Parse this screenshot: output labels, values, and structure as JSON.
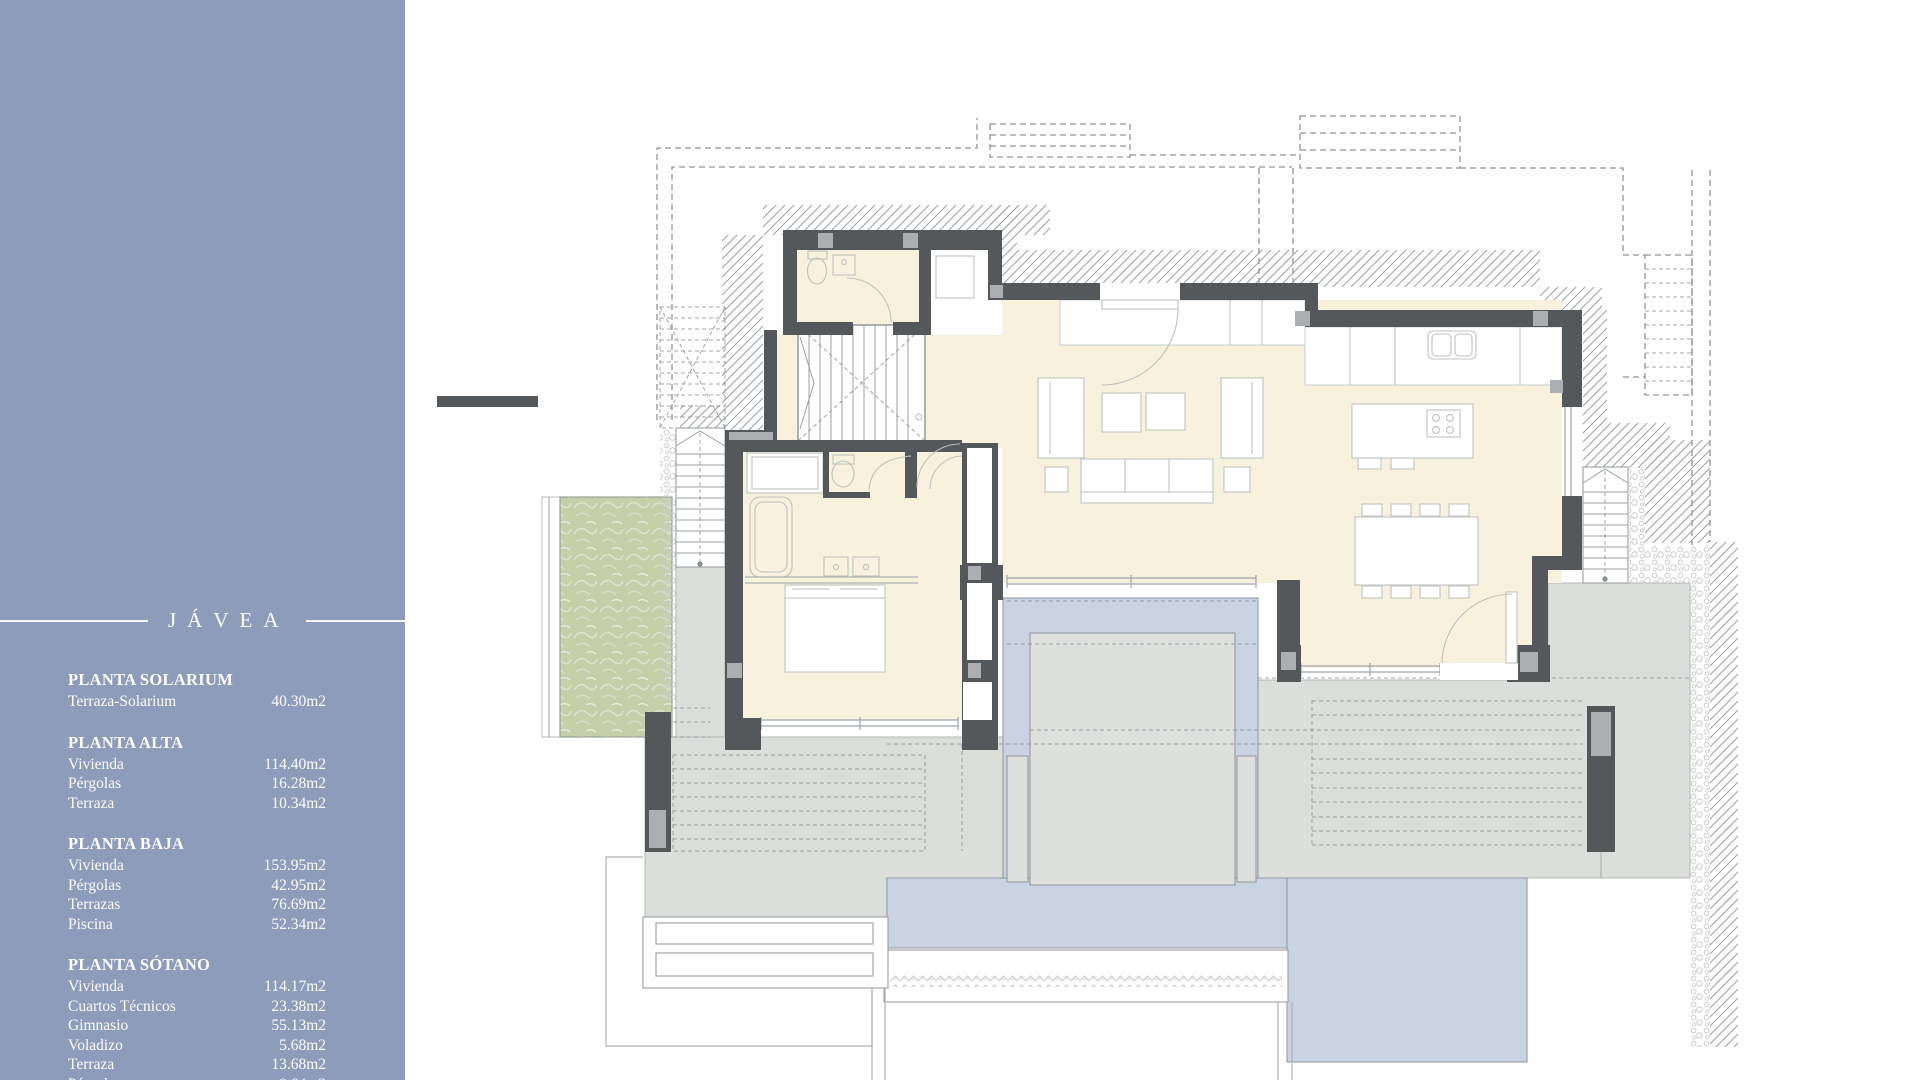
{
  "sidebar": {
    "title": "JÁVEA",
    "sections": [
      {
        "heading": "PLANTA SOLARIUM",
        "rows": [
          {
            "label": "Terraza-Solarium",
            "value": "40.30m2"
          }
        ]
      },
      {
        "heading": "PLANTA ALTA",
        "rows": [
          {
            "label": "Vivienda",
            "value": "114.40m2"
          },
          {
            "label": "Pérgolas",
            "value": "16.28m2"
          },
          {
            "label": "Terraza",
            "value": "10.34m2"
          }
        ]
      },
      {
        "heading": "PLANTA BAJA",
        "rows": [
          {
            "label": "Vivienda",
            "value": "153.95m2"
          },
          {
            "label": "Pérgolas",
            "value": "42.95m2"
          },
          {
            "label": "Terrazas",
            "value": "76.69m2"
          },
          {
            "label": "Piscina",
            "value": "52.34m2"
          }
        ]
      },
      {
        "heading": "PLANTA SÓTANO",
        "rows": [
          {
            "label": "Vivienda",
            "value": "114.17m2"
          },
          {
            "label": "Cuartos Técnicos",
            "value": "23.38m2"
          },
          {
            "label": "Gimnasio",
            "value": "55.13m2"
          },
          {
            "label": "Voladizo",
            "value": "5.68m2"
          },
          {
            "label": "Terraza",
            "value": "13.68m2"
          },
          {
            "label": "Pérgola",
            "value": "9.64m2"
          }
        ]
      }
    ]
  },
  "colors": {
    "sidebar_bg": "#8C9CBA",
    "wall": "#55585B",
    "wall_pillar": "#ACAEB0",
    "floor": "#F8F1DE",
    "terrace": "#DCDEDB",
    "terrace_line": "#B5B8B6",
    "pool": "#C9D3E2",
    "pool_line": "#8E959C",
    "platform": "#DEE0DE",
    "green": "#C5CFA8",
    "hatch": "#9BA1A4",
    "dash": "#8F9598",
    "thin": "#ADB2B0",
    "glass": "#9FA5A8"
  }
}
